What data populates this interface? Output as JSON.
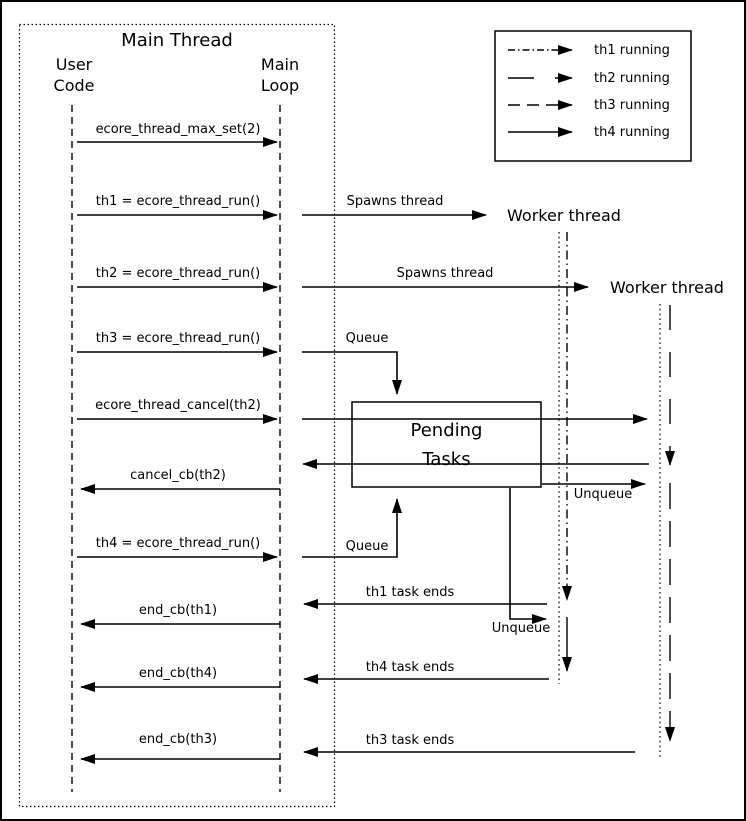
{
  "diagram": {
    "main_thread": {
      "title": "Main Thread",
      "user_code": {
        "line1": "User",
        "line2": "Code"
      },
      "main_loop": {
        "line1": "Main",
        "line2": "Loop"
      }
    },
    "legend": {
      "items": [
        {
          "label": "th1 running",
          "style": "dash-dot"
        },
        {
          "label": "th2 running",
          "style": "long-dash"
        },
        {
          "label": "th3 running",
          "style": "dash"
        },
        {
          "label": "th4 running",
          "style": "solid"
        }
      ]
    },
    "calls": [
      {
        "label": "ecore_thread_max_set(2)",
        "direction": "right"
      },
      {
        "label": "th1 = ecore_thread_run()",
        "direction": "right"
      },
      {
        "label": "th2 = ecore_thread_run()",
        "direction": "right"
      },
      {
        "label": "th3 = ecore_thread_run()",
        "direction": "right"
      },
      {
        "label": "ecore_thread_cancel(th2)",
        "direction": "right"
      },
      {
        "label": "cancel_cb(th2)",
        "direction": "left"
      },
      {
        "label": "th4 = ecore_thread_run()",
        "direction": "right"
      },
      {
        "label": "end_cb(th1)",
        "direction": "left"
      },
      {
        "label": "end_cb(th4)",
        "direction": "left"
      },
      {
        "label": "end_cb(th3)",
        "direction": "left"
      }
    ],
    "annotations": {
      "spawns_thread_1": "Spawns thread",
      "spawns_thread_2": "Spawns thread",
      "queue_1": "Queue",
      "queue_2": "Queue",
      "unqueue_1": "Unqueue",
      "unqueue_2": "Unqueue",
      "th1_task_ends": "th1 task ends",
      "th4_task_ends": "th4 task ends",
      "th3_task_ends": "th3 task ends"
    },
    "workers": {
      "worker1_label": "Worker thread",
      "worker2_label": "Worker thread"
    },
    "pending_tasks": {
      "line1": "Pending",
      "line2": "Tasks"
    }
  },
  "colors": {
    "line": "#000000",
    "background": "#ffffff"
  }
}
